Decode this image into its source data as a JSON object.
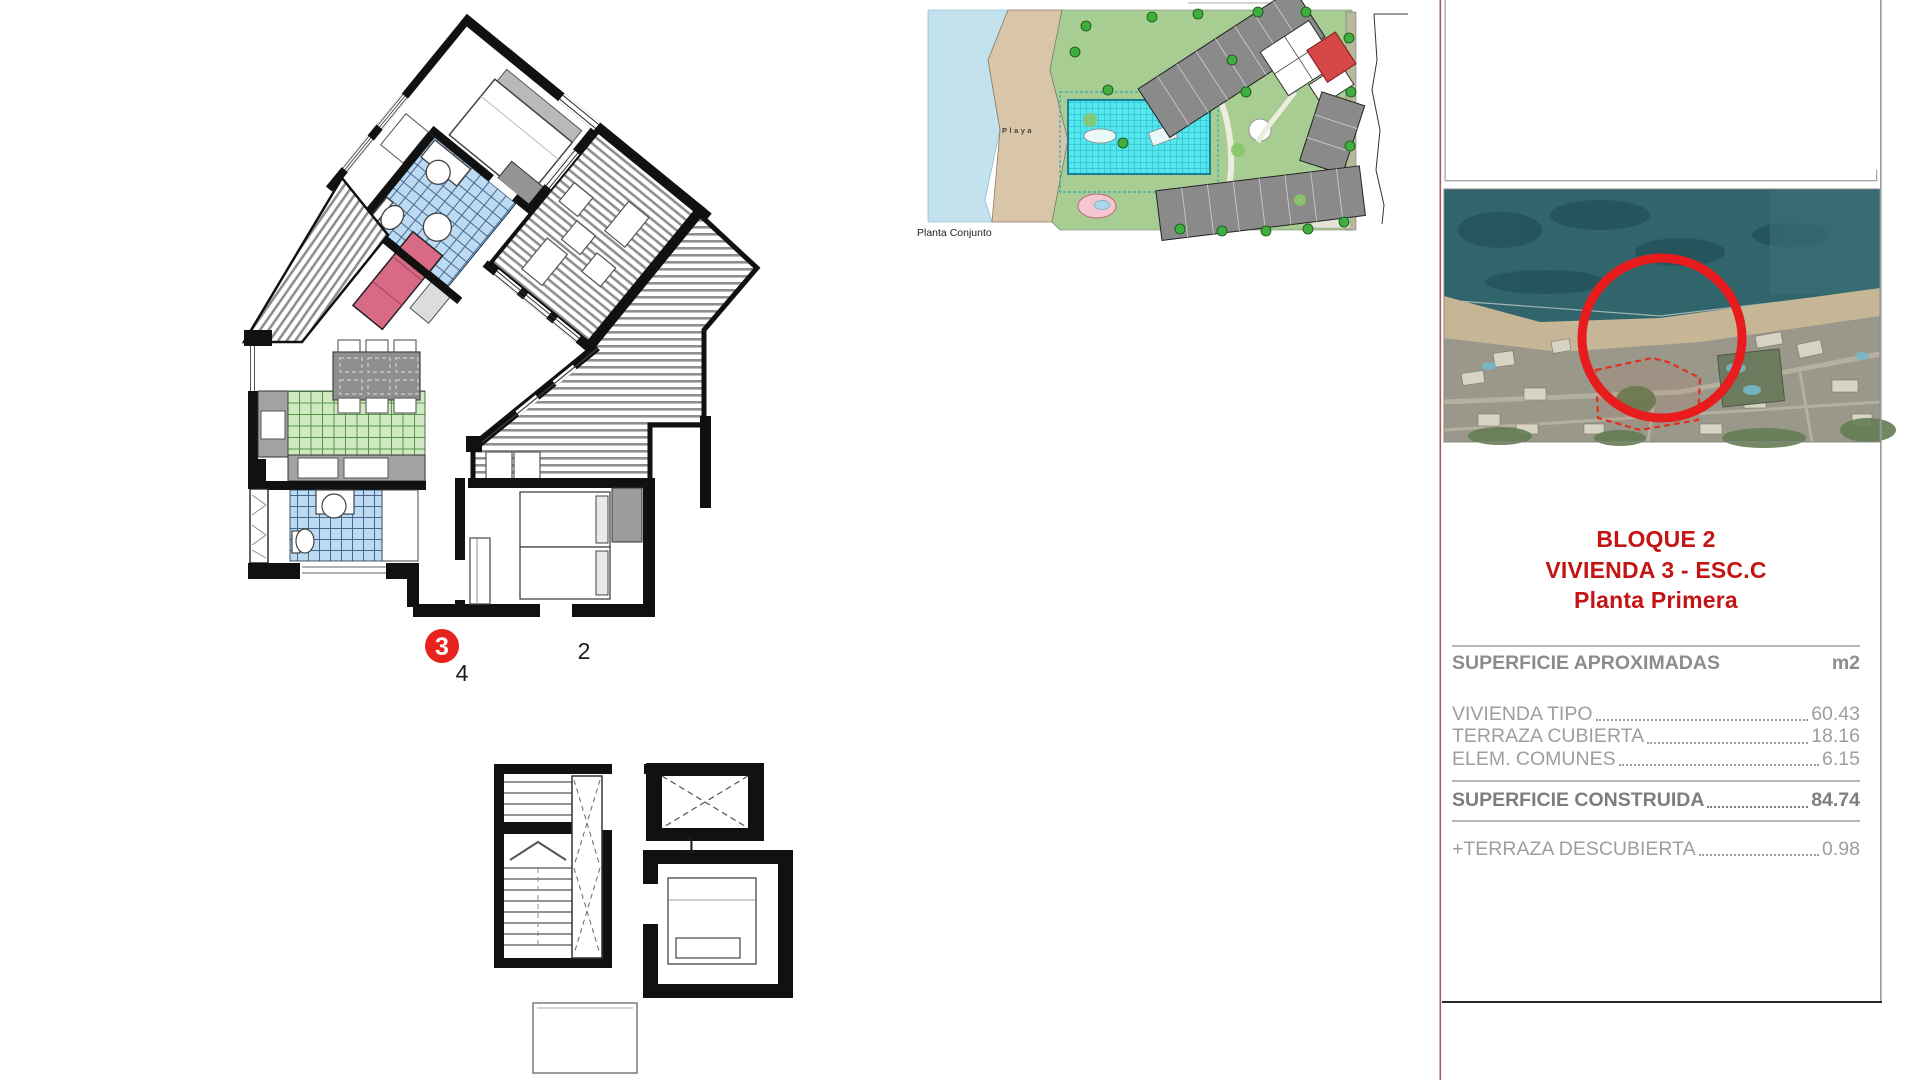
{
  "floor_plan": {
    "unit_badge": "3",
    "badge_color": "#e8221c",
    "labels": {
      "left_unit": "4",
      "right_unit": "2",
      "lower_unit": "1"
    },
    "colors": {
      "walls": "#111111",
      "bath_tiles": "#bcdaf2",
      "kitchen_tiles": "#cfe9c0",
      "sofa": "#d96a85",
      "terrace_hatch": "#8f8f8f"
    }
  },
  "site_plan": {
    "caption": "Planta Conjunto",
    "beach_label": "Playa",
    "colors": {
      "sea": "#c2e2ee",
      "beach": "#d9c6a8",
      "lawn": "#a8cd92",
      "pool": "#55e6ee",
      "buildings": "#8a8a8a",
      "highlight_unit": "#d64848",
      "pond": "#f4c6d2"
    }
  },
  "location_map": {
    "marker_color": "#e81c1c",
    "plot_outline_color": "#e0311f"
  },
  "info_panel": {
    "title_line1": "BLOQUE 2",
    "title_line2": "VIVIENDA 3 - ESC.C",
    "title_line3": "Planta Primera",
    "title_color": "#c41414",
    "header_label": "SUPERFICIE APROXIMADAS",
    "header_unit": "m2",
    "rows": [
      {
        "label": "VIVIENDA TIPO",
        "value": "60.43"
      },
      {
        "label": "TERRAZA CUBIERTA",
        "value": "18.16"
      },
      {
        "label": "ELEM. COMUNES",
        "value": "6.15"
      }
    ],
    "total": {
      "label": "SUPERFICIE CONSTRUIDA",
      "value": "84.74"
    },
    "extra": {
      "label": "+TERRAZA DESCUBIERTA",
      "value": "0.98"
    }
  }
}
